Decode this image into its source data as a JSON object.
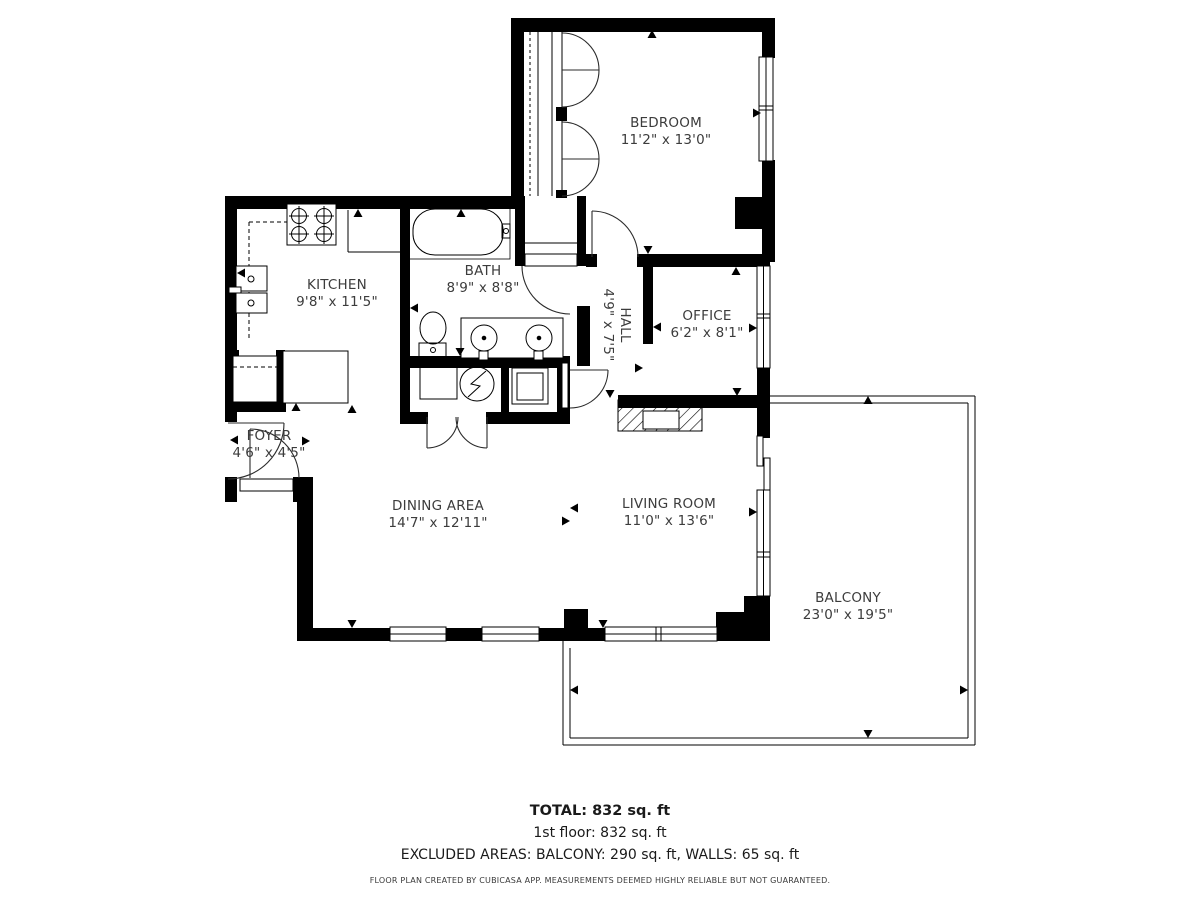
{
  "colors": {
    "wall": "#000000",
    "label_text": "#3c3c3c",
    "footer_text": "#1a1a1a"
  },
  "rooms": [
    {
      "id": "bedroom",
      "name": "BEDROOM",
      "dims": "11'2\" x 13'0\""
    },
    {
      "id": "kitchen",
      "name": "KITCHEN",
      "dims": "9'8\" x 11'5\""
    },
    {
      "id": "bath",
      "name": "BATH",
      "dims": "8'9\" x 8'8\""
    },
    {
      "id": "hall",
      "name": "HALL",
      "dims": "4'9\" x 7'5\""
    },
    {
      "id": "office",
      "name": "OFFICE",
      "dims": "6'2\" x 8'1\""
    },
    {
      "id": "foyer",
      "name": "FOYER",
      "dims": "4'6\" x 4'5\""
    },
    {
      "id": "dining_area",
      "name": "DINING AREA",
      "dims": "14'7\" x 12'11\""
    },
    {
      "id": "living_room",
      "name": "LIVING ROOM",
      "dims": "11'0\" x 13'6\""
    },
    {
      "id": "balcony",
      "name": "BALCONY",
      "dims": "23'0\" x 19'5\""
    }
  ],
  "summary": {
    "total": "TOTAL: 832 sq. ft",
    "first_floor": "1st floor: 832 sq. ft",
    "excluded_areas": "EXCLUDED AREAS: BALCONY: 290 sq. ft, WALLS: 65 sq. ft",
    "credit": "FLOOR PLAN CREATED BY CUBICASA APP. MEASUREMENTS DEEMED HIGHLY RELIABLE BUT NOT GUARANTEED."
  }
}
